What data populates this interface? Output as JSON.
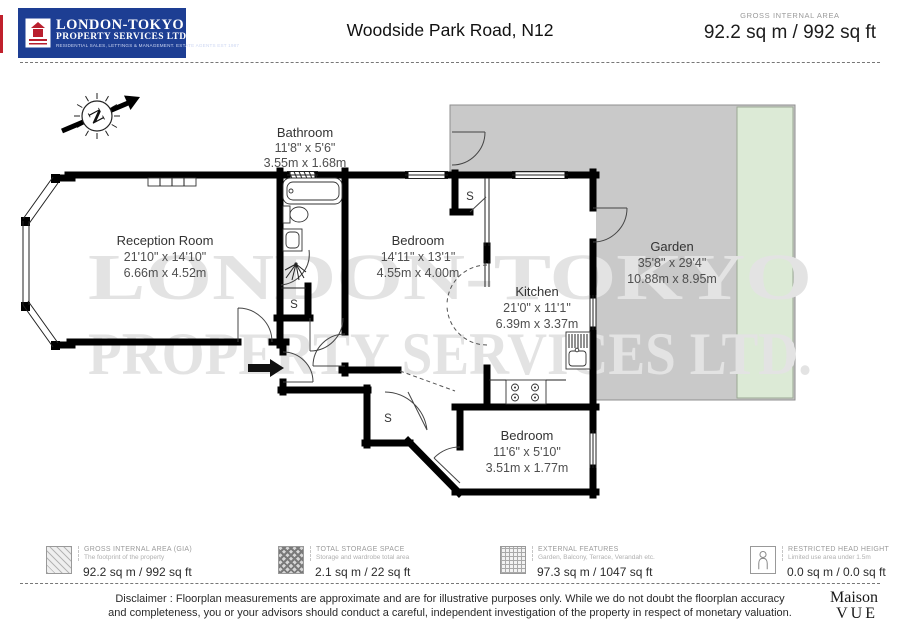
{
  "header": {
    "logo": {
      "line1": "LONDON-TOKYO",
      "line2": "PROPERTY SERVICES LTD.",
      "line3": "RESIDENTIAL SALES, LETTINGS & MANAGEMENT. ESTATE AGENTS EST 1987"
    },
    "title": "Woodside Park Road, N12",
    "gia_label": "GROSS INTERNAL AREA",
    "gia_value": "92.2 sq m / 992 sq ft"
  },
  "compass": {
    "letter": "N"
  },
  "watermark": {
    "line1": "LONDON-TOKYO",
    "line2": "PROPERTY SERVICES LTD."
  },
  "storage_label": "S",
  "rooms": {
    "bathroom": {
      "name": "Bathroom",
      "imperial": "11'8\" x 5'6\"",
      "metric": "3.55m x 1.68m"
    },
    "reception": {
      "name": "Reception Room",
      "imperial": "21'10\" x 14'10\"",
      "metric": "6.66m x 4.52m"
    },
    "bedroom1": {
      "name": "Bedroom",
      "imperial": "14'11\" x 13'1\"",
      "metric": "4.55m x 4.00m"
    },
    "kitchen": {
      "name": "Kitchen",
      "imperial": "21'0\" x 11'1\"",
      "metric": "6.39m x 3.37m"
    },
    "garden": {
      "name": "Garden",
      "imperial": "35'8\" x 29'4\"",
      "metric": "10.88m x 8.95m"
    },
    "bedroom2": {
      "name": "Bedroom",
      "imperial": "11'6\" x 5'10\"",
      "metric": "3.51m x 1.77m"
    }
  },
  "legend": {
    "items": [
      {
        "title": "GROSS INTERNAL AREA (GIA)",
        "subtitle": "The footprint of the property",
        "value": "92.2 sq m / 992 sq ft"
      },
      {
        "title": "TOTAL STORAGE SPACE",
        "subtitle": "Storage and wardrobe total area",
        "value": "2.1 sq m / 22 sq ft"
      },
      {
        "title": "EXTERNAL FEATURES",
        "subtitle": "Garden, Balcony, Terrace, Verandah etc.",
        "value": "97.3 sq m / 1047 sq ft"
      },
      {
        "title": "RESTRICTED HEAD HEIGHT",
        "subtitle": "Limited use area under 1.5m",
        "value": "0.0 sq m / 0.0 sq ft"
      }
    ]
  },
  "footer": {
    "disclaimer_line1": "Disclaimer : Floorplan measurements are approximate and are for illustrative purposes only. While we do not doubt the floorplan accuracy",
    "disclaimer_line2": "and completeness, you or your advisors should conduct a careful, independent investigation of the property in respect of monetary valuation.",
    "brand_line1": "Maison",
    "brand_line2": "VUE"
  },
  "colors": {
    "logo_bg": "#1d3e93",
    "logo_red": "#b91f2e",
    "garden_gray": "#c9c9c9",
    "lawn_green": "#dcead6",
    "watermark": "#e3e3e3"
  }
}
